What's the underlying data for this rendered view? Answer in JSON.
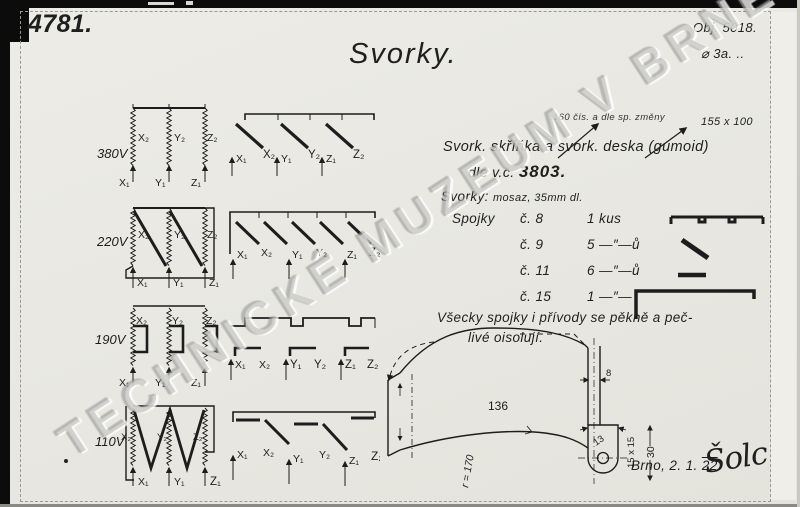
{
  "page": {
    "drawing_number": "4781.",
    "object_number": "Obj. 5018.",
    "object_sub": "⌀ 3a. ..",
    "title": "Svorky.",
    "watermark": "TECHNICKÉ MUZEUM V BRNĚ",
    "date_prefix": "Brno, 2. 1. ",
    "date_year": "22",
    "date_suffix": ".",
    "signature": "Šolc"
  },
  "notes": {
    "revision": "160 čís. a dle sp. změny",
    "size": "155 x 100",
    "line1": "Svork. skříňka a svork. deska (gumoid)",
    "line2_prefix": "dle v.č.",
    "line2_number": "3803.",
    "line3_label": "Svorky:",
    "line3_value": "mosaz, 35mm dl.",
    "iso1": "Všecky spojky i přívody se pěkně a peč-",
    "iso2": "livé oisolují."
  },
  "spojky": {
    "label": "Spojky",
    "rows": [
      {
        "cislo": "č. 8",
        "pocet": "1 kus",
        "icon": "bridge-bar"
      },
      {
        "cislo": "č. 9",
        "pocet": "5 —″—ů",
        "icon": "diagonal-link"
      },
      {
        "cislo": "č. 11",
        "pocet": "6 —″—ů",
        "icon": "short-link"
      },
      {
        "cislo": "č. 15",
        "pocet": "1 —″—",
        "icon": "l-bracket"
      }
    ]
  },
  "diagrams": {
    "rows": [
      {
        "voltage": "380V",
        "x1": "X₁",
        "x2": "X₂",
        "y1": "Y₁",
        "y2": "Y₂",
        "z1": "Z₁",
        "z2": "Z₂"
      },
      {
        "voltage": "220V",
        "x1": "X₁",
        "x2": "X₂",
        "y1": "Y₁",
        "y2": "Y₂",
        "z1": "Z₁",
        "z2": "Z₂"
      },
      {
        "voltage": "190V",
        "x1": "X₁",
        "x2": "X₂",
        "y1": "Y₁",
        "y2": "Y₂",
        "z1": "Z₁",
        "z2": "Z₂"
      },
      {
        "voltage": "110V",
        "x1": "X₁",
        "x2": "X₂",
        "y1": "Y₁",
        "y2": "Y₂",
        "z1": "Z₁",
        "z2": "Z₂"
      }
    ]
  },
  "strap": {
    "w136": "136",
    "r170": "r = 170",
    "d8": "8",
    "d13": "13",
    "d15": "15 x 15",
    "d30": "30"
  }
}
